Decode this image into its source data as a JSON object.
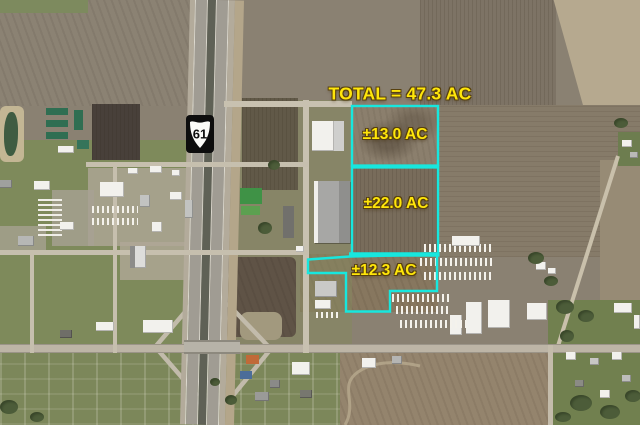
{
  "overlay": {
    "total_label": "TOTAL = 47.3 AC",
    "total_acres": 47.3,
    "parcels": [
      {
        "label": "±13.0 AC",
        "acres": 13.0
      },
      {
        "label": "±22.0 AC",
        "acres": 22.0
      },
      {
        "label": "±12.3 AC",
        "acres": 12.3
      }
    ],
    "colors": {
      "boundary": "#17e7de",
      "label_text": "#ffe60a",
      "label_outline": "#57400e"
    }
  },
  "highway_shield": {
    "route": "61"
  }
}
